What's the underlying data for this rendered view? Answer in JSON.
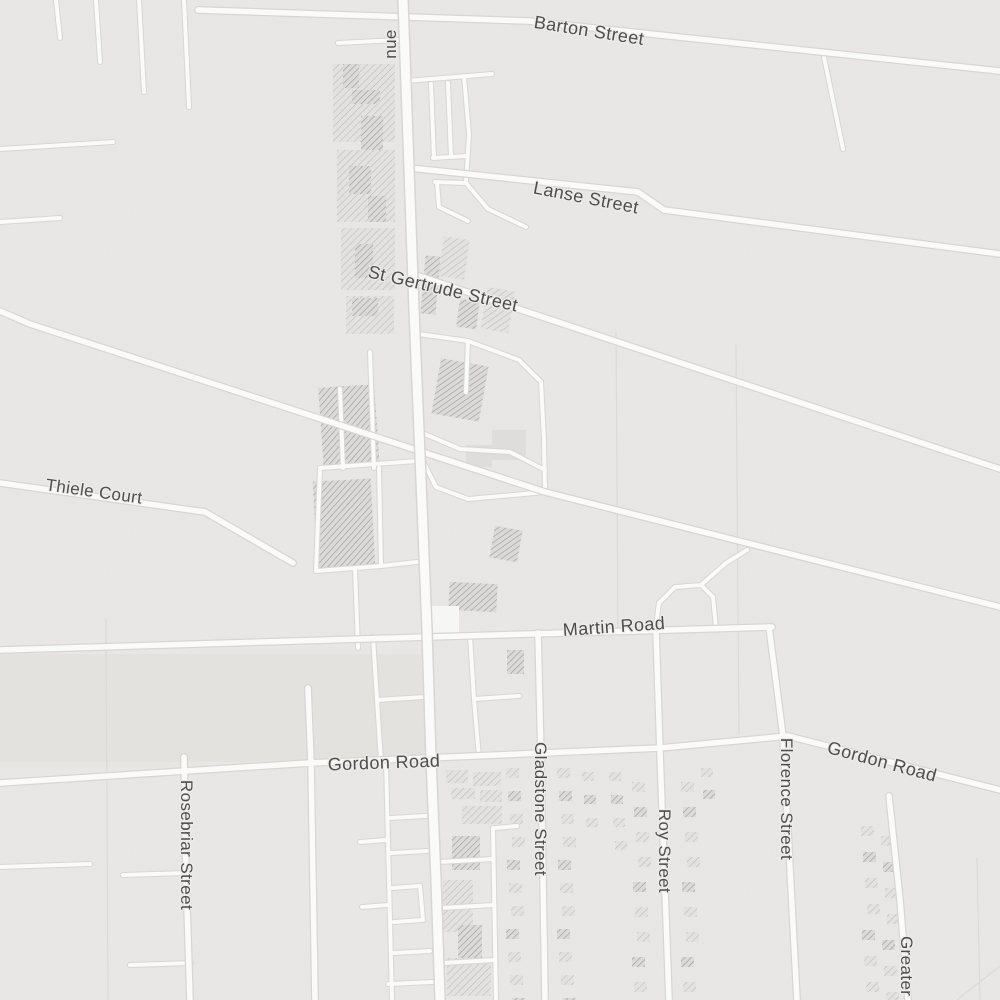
{
  "map": {
    "colors": {
      "background": "#e9e8e6",
      "road_fill": "#fcfcfb",
      "road_casing": "#d8d7d5",
      "parcel_line": "#dcdbd9",
      "label_text": "#4d4d4b",
      "hatch_light_line": "#bdbcba",
      "hatch_dark_line": "#9e9d9b",
      "building_flat": "#dfdedc"
    },
    "labels": [
      {
        "id": "avenue-partial",
        "text": "nue",
        "x": 391,
        "y": 44,
        "rot": -90,
        "size": 17
      },
      {
        "id": "barton-street",
        "text": "Barton Street",
        "x": 589,
        "y": 31,
        "rot": 9,
        "size": 18
      },
      {
        "id": "lanse-street",
        "text": "Lanse Street",
        "x": 586,
        "y": 198,
        "rot": 11,
        "size": 18
      },
      {
        "id": "st-gertrude-street",
        "text": "St Gertrude Street",
        "x": 443,
        "y": 289,
        "rot": 13,
        "size": 18
      },
      {
        "id": "thiele-court",
        "text": "Thiele Court",
        "x": 94,
        "y": 492,
        "rot": 8,
        "size": 17
      },
      {
        "id": "martin-road",
        "text": "Martin Road",
        "x": 614,
        "y": 627,
        "rot": -4,
        "size": 18
      },
      {
        "id": "gordon-road-west",
        "text": "Gordon Road",
        "x": 384,
        "y": 763,
        "rot": -2,
        "size": 18
      },
      {
        "id": "gordon-road-east",
        "text": "Gordon Road",
        "x": 882,
        "y": 762,
        "rot": 15,
        "size": 18
      },
      {
        "id": "rosebriar-street",
        "text": "Rosebriar Street",
        "x": 186,
        "y": 845,
        "rot": 90,
        "size": 17
      },
      {
        "id": "gladstone-street",
        "text": "Gladstone Street",
        "x": 540,
        "y": 809,
        "rot": 90,
        "size": 17
      },
      {
        "id": "roy-street",
        "text": "Roy Street",
        "x": 664,
        "y": 851,
        "rot": 90,
        "size": 17
      },
      {
        "id": "florence-street",
        "text": "Florence Street",
        "x": 786,
        "y": 799,
        "rot": 90,
        "size": 17
      },
      {
        "id": "greater-m-street",
        "text": "Greater M",
        "x": 906,
        "y": 976,
        "rot": 90,
        "size": 17
      }
    ],
    "roads": {
      "major": [
        "M403,0 L408,140 L414,310 L421,480 L427,630 L431,758 L436,880 L440,1000"
      ],
      "primary": [
        "M198,10 L528,21 L1000,71",
        "M410,168 L638,192 L664,210 L1000,254",
        "M413,274 L1000,469",
        "M0,311 L30,324 L545,492 L1000,607",
        "M0,483 L205,512 L293,563",
        "M0,650 L428,637 L772,627",
        "M0,783 L310,763 L660,748 L788,736 L1000,790",
        "M184,757 L186,875 L190,1000",
        "M538,633 L541,757 L545,1000",
        "M656,631 L660,752 L669,1000",
        "M769,627 L783,736 L797,1000",
        "M889,796 L900,900 L908,1000",
        "M308,688 L311,762 L315,1000"
      ],
      "minor": [
        "M56,0 L60,38",
        "M96,0 L100,62",
        "M139,0 L144,92",
        "M184,0 L189,107",
        "M0,149 L113,142",
        "M0,222 L60,218",
        "M824,57 L843,149",
        "M338,43 L398,40",
        "M406,81 L492,74",
        "M464,76 L469,134 L466,183",
        "M431,84 L434,158",
        "M448,83 L451,157",
        "M433,158 L466,156",
        "M435,182 L466,183",
        "M466,183 L488,209 L526,227",
        "M437,183 L439,207 L468,221",
        "M412,333 L468,341 L519,360 L541,382",
        "M541,382 L544,440 L545,492",
        "M468,341 L466,392",
        "M420,432 L460,449 L510,452 L545,470",
        "M420,455 L436,487 L468,499 L513,495 L545,492",
        "M370,352 L374,468",
        "M340,389 L343,468",
        "M320,468 L417,461",
        "M320,468 L316,571",
        "M316,571 L381,566",
        "M379,468 L381,566",
        "M381,566 L417,562",
        "M355,568 L358,648",
        "M373,637 L377,700 L381,762",
        "M377,700 L424,697",
        "M470,636 L474,699 L479,757",
        "M474,699 L519,696",
        "M655,631 L659,603 L675,587 L701,585 L713,597 L716,628",
        "M701,585 L726,563 L747,550",
        "M0,867 L90,864",
        "M123,875 L186,873",
        "M130,965 L191,963",
        "M386,762 L392,1000",
        "M390,818 L426,816",
        "M391,853 L427,851",
        "M392,888 L420,886 L423,920 L394,922",
        "M394,953 L430,951",
        "M388,984 L433,982",
        "M360,842 L386,840",
        "M362,907 L388,905",
        "M493,828 L496,1000",
        "M438,862 L493,859",
        "M440,908 L494,905",
        "M442,963 L495,960",
        "M496,828 L517,826"
      ]
    },
    "parcel_lines": [
      "M616,332 L618,630",
      "M736,345 L739,735",
      "M106,618 L108,1000",
      "M977,858 L980,1000",
      "M957,1000 L1000,966"
    ],
    "shade_areas": [
      {
        "x": 0,
        "y": 654,
        "w": 428,
        "h": 108
      }
    ],
    "hatch_blocks": [
      {
        "x": 333,
        "y": 64,
        "w": 62,
        "h": 78,
        "rot": 0,
        "tone": "light"
      },
      {
        "x": 337,
        "y": 150,
        "w": 58,
        "h": 72,
        "rot": 0,
        "tone": "light"
      },
      {
        "x": 341,
        "y": 228,
        "w": 54,
        "h": 62,
        "rot": 0,
        "tone": "light"
      },
      {
        "x": 346,
        "y": 296,
        "w": 48,
        "h": 38,
        "rot": 0,
        "tone": "light"
      },
      {
        "x": 343,
        "y": 64,
        "w": 16,
        "h": 24,
        "rot": 0,
        "tone": "dark"
      },
      {
        "x": 352,
        "y": 90,
        "w": 28,
        "h": 14,
        "rot": 0,
        "tone": "dark"
      },
      {
        "x": 361,
        "y": 116,
        "w": 22,
        "h": 34,
        "rot": 0,
        "tone": "dark"
      },
      {
        "x": 349,
        "y": 166,
        "w": 22,
        "h": 28,
        "rot": 0,
        "tone": "dark"
      },
      {
        "x": 368,
        "y": 196,
        "w": 18,
        "h": 26,
        "rot": 0,
        "tone": "dark"
      },
      {
        "x": 355,
        "y": 244,
        "w": 18,
        "h": 34,
        "rot": 0,
        "tone": "dark"
      },
      {
        "x": 352,
        "y": 298,
        "w": 26,
        "h": 18,
        "rot": 0,
        "tone": "dark"
      },
      {
        "x": 441,
        "y": 238,
        "w": 26,
        "h": 40,
        "rot": 8,
        "tone": "light"
      },
      {
        "x": 423,
        "y": 256,
        "w": 15,
        "h": 58,
        "rot": 5,
        "tone": "dark"
      },
      {
        "x": 484,
        "y": 289,
        "w": 28,
        "h": 42,
        "rot": 10,
        "tone": "light"
      },
      {
        "x": 458,
        "y": 300,
        "w": 20,
        "h": 28,
        "rot": 8,
        "tone": "dark"
      },
      {
        "x": 436,
        "y": 362,
        "w": 48,
        "h": 56,
        "rot": 10,
        "tone": "dark"
      },
      {
        "x": 492,
        "y": 430,
        "w": 34,
        "h": 30,
        "rot": 0,
        "tone": "flat"
      },
      {
        "x": 466,
        "y": 445,
        "w": 26,
        "h": 22,
        "rot": 0,
        "tone": "flat"
      },
      {
        "x": 321,
        "y": 386,
        "w": 56,
        "h": 82,
        "rot": -4,
        "tone": "dark"
      },
      {
        "x": 315,
        "y": 480,
        "w": 58,
        "h": 88,
        "rot": -3,
        "tone": "dark"
      },
      {
        "x": 449,
        "y": 583,
        "w": 48,
        "h": 28,
        "rot": 3,
        "tone": "dark"
      },
      {
        "x": 507,
        "y": 650,
        "w": 17,
        "h": 24,
        "rot": 0,
        "tone": "dark"
      },
      {
        "x": 492,
        "y": 528,
        "w": 28,
        "h": 32,
        "rot": 10,
        "tone": "dark"
      },
      {
        "x": 427,
        "y": 606,
        "w": 32,
        "h": 30,
        "rot": 0,
        "tone": "white"
      },
      {
        "x": 446,
        "y": 770,
        "w": 22,
        "h": 13,
        "rot": 0,
        "tone": "light"
      },
      {
        "x": 473,
        "y": 772,
        "w": 28,
        "h": 14,
        "rot": 0,
        "tone": "light"
      },
      {
        "x": 451,
        "y": 788,
        "w": 24,
        "h": 11,
        "rot": 0,
        "tone": "light"
      },
      {
        "x": 480,
        "y": 790,
        "w": 22,
        "h": 12,
        "rot": 0,
        "tone": "light"
      },
      {
        "x": 462,
        "y": 806,
        "w": 40,
        "h": 18,
        "rot": 0,
        "tone": "light"
      },
      {
        "x": 452,
        "y": 836,
        "w": 28,
        "h": 34,
        "rot": 0,
        "tone": "dark"
      },
      {
        "x": 443,
        "y": 880,
        "w": 30,
        "h": 52,
        "rot": 0,
        "tone": "light"
      },
      {
        "x": 458,
        "y": 925,
        "w": 24,
        "h": 38,
        "rot": 0,
        "tone": "dark"
      },
      {
        "x": 447,
        "y": 958,
        "w": 44,
        "h": 38,
        "rot": 0,
        "tone": "light"
      }
    ],
    "hatch_columns": [
      {
        "x": 509,
        "y0": 768,
        "y1": 998,
        "step": 23,
        "w": 13,
        "h": 10
      },
      {
        "x": 560,
        "y0": 768,
        "y1": 998,
        "step": 23,
        "w": 13,
        "h": 10
      },
      {
        "x": 585,
        "y0": 772,
        "y1": 830,
        "step": 23,
        "w": 12,
        "h": 9
      },
      {
        "x": 612,
        "y0": 772,
        "y1": 860,
        "step": 23,
        "w": 12,
        "h": 9
      },
      {
        "x": 635,
        "y0": 782,
        "y1": 998,
        "step": 25,
        "w": 13,
        "h": 10
      },
      {
        "x": 684,
        "y0": 782,
        "y1": 998,
        "step": 25,
        "w": 13,
        "h": 10
      },
      {
        "x": 704,
        "y0": 768,
        "y1": 800,
        "step": 22,
        "w": 12,
        "h": 9
      },
      {
        "x": 864,
        "y0": 826,
        "y1": 998,
        "step": 26,
        "w": 13,
        "h": 10
      },
      {
        "x": 884,
        "y0": 836,
        "y1": 998,
        "step": 26,
        "w": 13,
        "h": 10
      }
    ]
  }
}
